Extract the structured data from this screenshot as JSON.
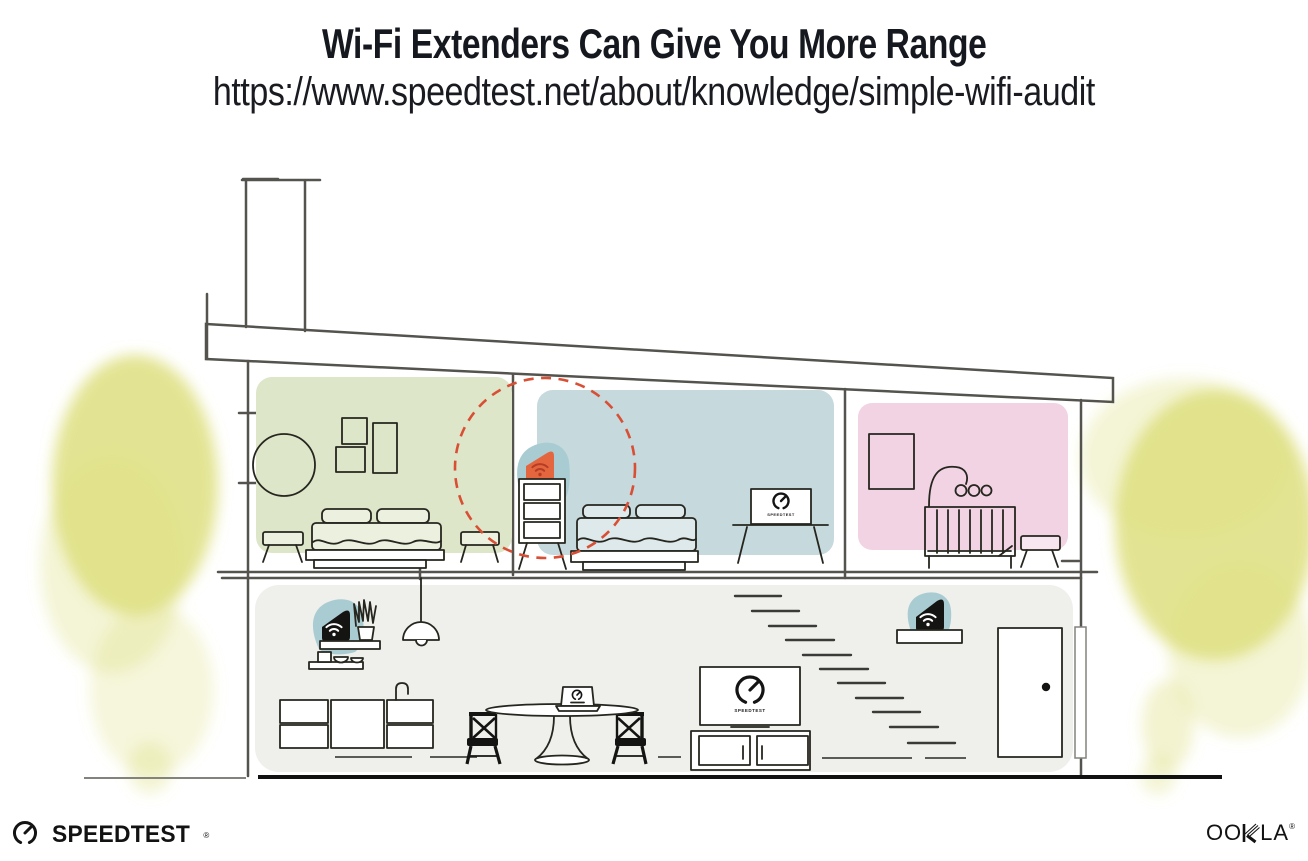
{
  "header": {
    "title": "Wi-Fi Extenders Can Give You More Range",
    "url": "https://www.speedtest.net/about/knowledge/simple-wifi-audit"
  },
  "illustration": {
    "tv_brand": "SPEEDTEST",
    "icons": {
      "extender_device": "wifi-extender-icon",
      "router_device": "wifi-router-icon",
      "tv_logo": "speedtest-gauge-icon",
      "coverage": "wifi-range-dashed-circle"
    }
  },
  "footer": {
    "speedtest_label": "SPEEDTEST",
    "speedtest_reg": "®",
    "ookla_prefix": "OO",
    "ookla_suffix": "LA",
    "ookla_reg": "®"
  },
  "colors": {
    "ink": "#16181f",
    "line_gray": "#54534e",
    "room_green": "#dde6c8",
    "room_blue": "#c6d9dd",
    "room_pink": "#f1d3e4",
    "floor_gray": "#efefec",
    "device_teal": "#a9ccd2",
    "device_orange": "#e4663f",
    "wifi_red": "#b63c25",
    "accent_red": "#d94f35",
    "tree_yellow": "#dcdd78"
  }
}
